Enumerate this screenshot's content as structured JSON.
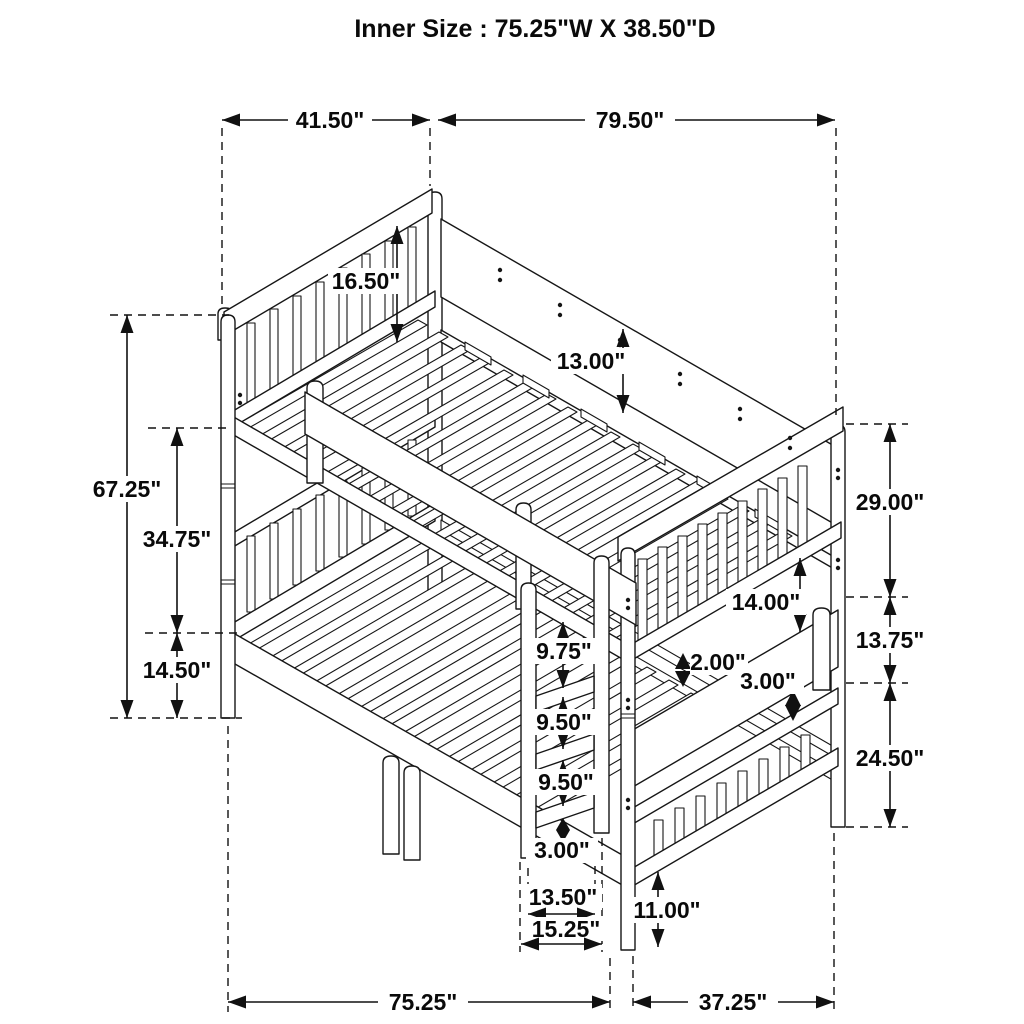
{
  "title": "Inner Size : 75.25\"W X  38.50\"D",
  "dims": {
    "overall_width_top": "41.50\"",
    "overall_length_top": "79.50\"",
    "overall_height": "67.25\"",
    "upper_rail_height": "34.75\"",
    "lower_rail_height": "14.50\"",
    "headboard_guard_height": "16.50\"",
    "side_rail_height": "13.00\"",
    "foot_top_section": "29.00\"",
    "foot_mid_section": "13.75\"",
    "foot_bottom_section": "24.50\"",
    "foot_opening": "14.00\"",
    "slat_gap": "2.00\"",
    "panel_gap": "3.00\"",
    "ladder_top_spacing": "9.75\"",
    "ladder_mid_spacing": "9.50\"",
    "ladder_low_spacing": "9.50\"",
    "ladder_bottom_gap": "3.00\"",
    "ladder_inner_width": "13.50\"",
    "ladder_outer_width": "15.25\"",
    "floor_clearance": "11.00\"",
    "overall_length_bottom": "75.25\"",
    "overall_depth_bottom": "37.25\""
  }
}
